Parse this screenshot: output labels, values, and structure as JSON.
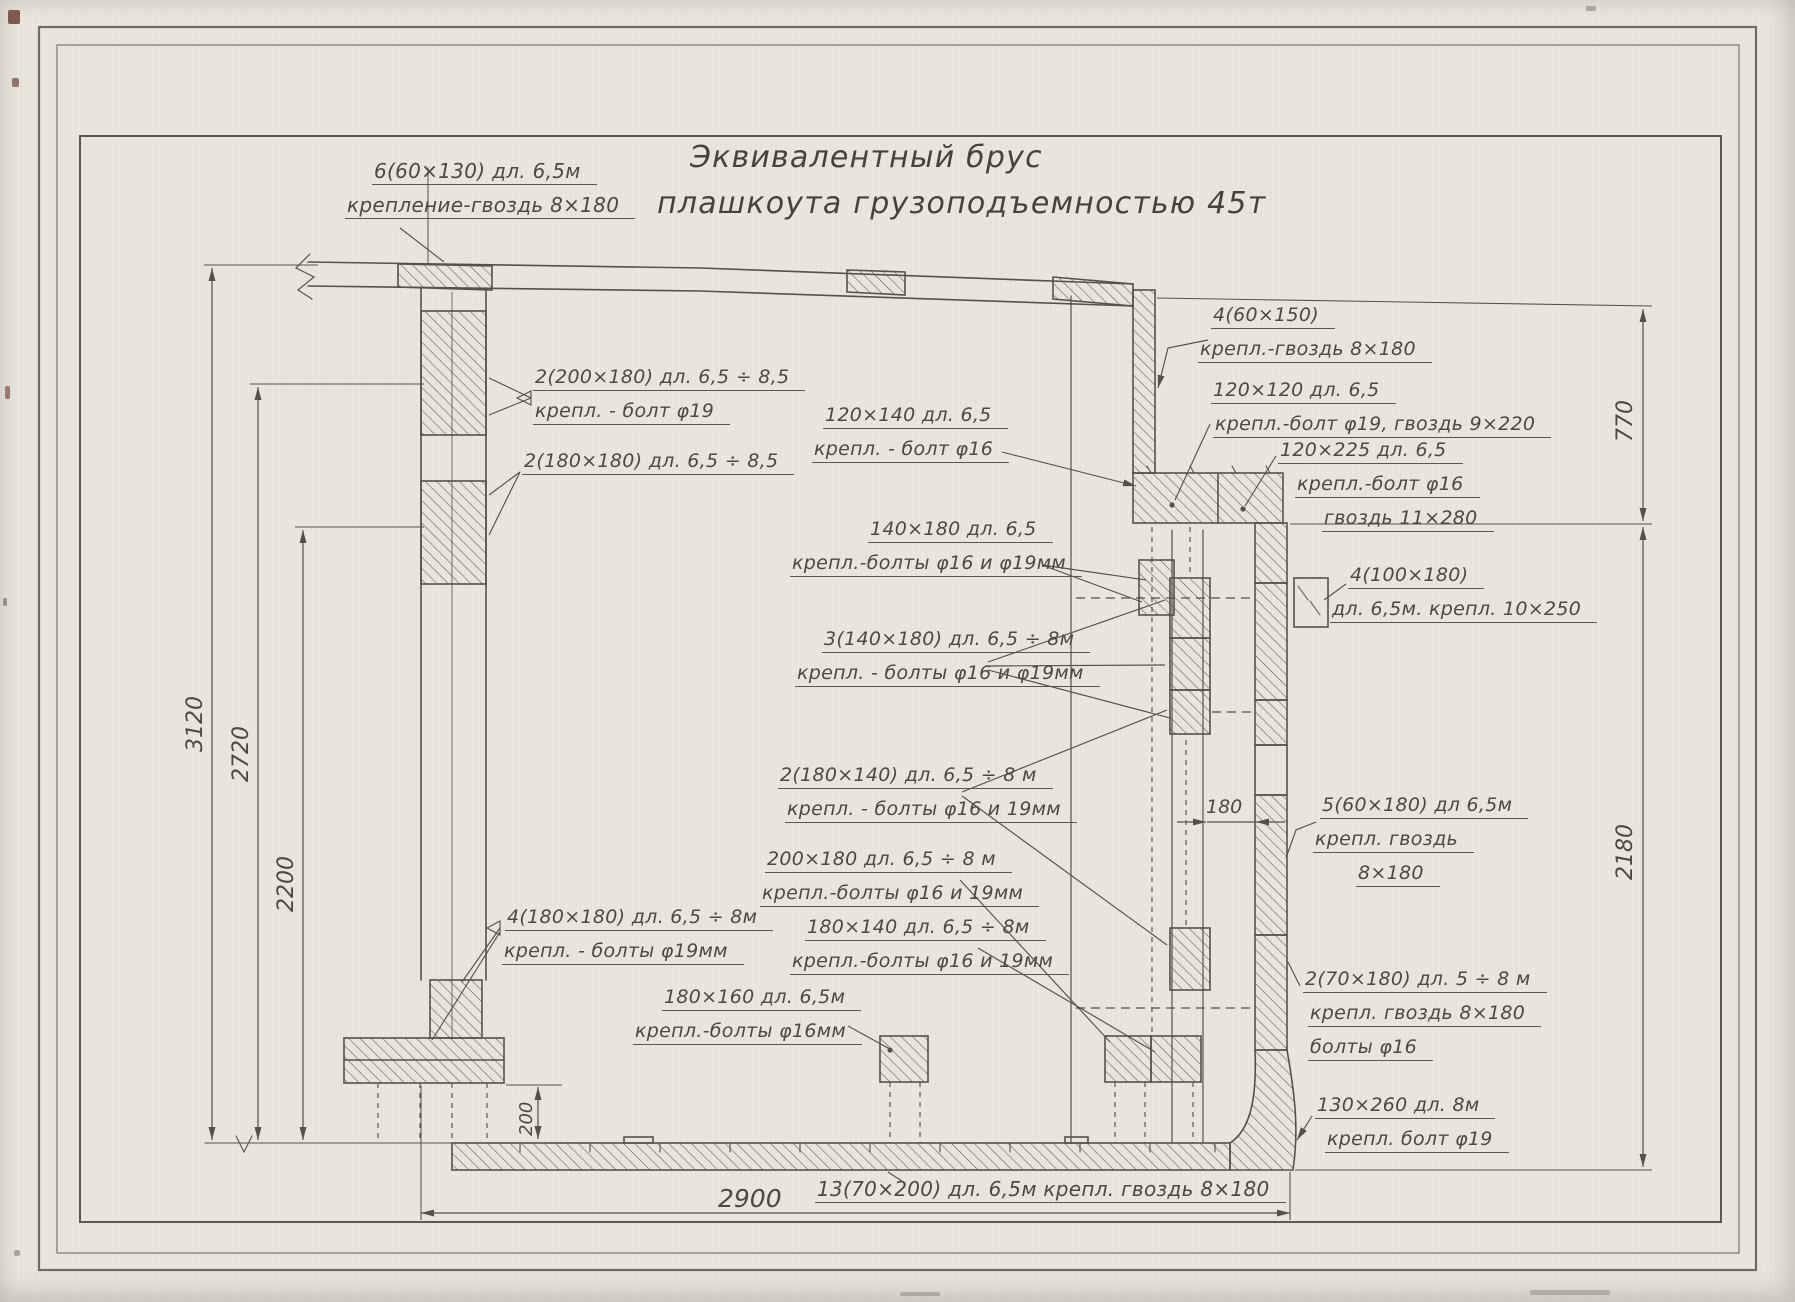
{
  "title": {
    "line1": "Эквивалентный брус",
    "line2": "плашкоута грузоподъемностью 45т"
  },
  "labels": {
    "deck_chock": {
      "line1": "6(60×130) дл. 6,5м",
      "line2": "крепление-гвоздь 8×180"
    },
    "frame_200x180": {
      "line1": "2(200×180) дл. 6,5 ÷ 8,5",
      "line2": "крепл. - болт φ19"
    },
    "frame_180x180": {
      "line1": "2(180×180) дл. 6,5 ÷ 8,5"
    },
    "beam_120x140": {
      "line1": "120×140 дл. 6,5",
      "line2": "крепл. - болт φ16"
    },
    "beam_140x180": {
      "line1": "140×180 дл. 6,5",
      "line2": "крепл.-болты φ16 и φ19мм"
    },
    "beam_3_140x180": {
      "line1": "3(140×180) дл. 6,5 ÷ 8м",
      "line2": "крепл. - болты φ16 и φ19мм"
    },
    "chock_2_180x140": {
      "line1": "2(180×140) дл. 6,5 ÷ 8 м",
      "line2": "крепл. - болты φ16 и 19мм"
    },
    "chock_200x180": {
      "line1": "200×180 дл. 6,5 ÷ 8 м",
      "line2": "крепл.-болты φ16 и 19мм"
    },
    "chock_180x140": {
      "line1": "180×140 дл. 6,5 ÷ 8м",
      "line2": "крепл.-болты φ16 и 19мм"
    },
    "frame_4_180x180": {
      "line1": "4(180×180) дл. 6,5 ÷ 8м",
      "line2": "крепл. - болты φ19мм"
    },
    "chock_180x160": {
      "line1": "180×160 дл. 6,5м",
      "line2": "крепл.-болты φ16мм"
    },
    "deck_4_60x150": {
      "line1": "4(60×150)",
      "line2": "крепл.-гвоздь 8×180"
    },
    "stringer_120x120": {
      "line1": "120×120 дл. 6,5",
      "line2": "крепл.-болт φ19, гвоздь 9×220"
    },
    "stringer_120x225": {
      "line1": "120×225 дл. 6,5",
      "line2": "крепл.-болт φ16",
      "line3": "гвоздь 11×280"
    },
    "nailer_4_100x180": {
      "line1": "4(100×180)",
      "line2": "дл. 6,5м. крепл. 10×250"
    },
    "shell_5_60x180": {
      "line1": "5(60×180) дл 6,5м",
      "line2": "крепл. гвоздь",
      "line3": "8×180"
    },
    "shell_2_70x180": {
      "line1": "2(70×180) дл. 5 ÷ 8 м",
      "line2": "крепл. гвоздь 8×180",
      "line3": "болты φ16"
    },
    "keel_130x260": {
      "line1": "130×260 дл. 8м",
      "line2": "крепл. болт φ19"
    }
  },
  "bottom_note": "13(70×200) дл. 6,5м крепл. гвоздь 8×180",
  "dimensions": {
    "d3120": "3120",
    "d2720": "2720",
    "d2200": "2200",
    "d200": "200",
    "d770": "770",
    "d2180": "2180",
    "d180": "180",
    "d2900": "2900"
  },
  "colors": {
    "paper": "#e9e6df",
    "line": "#55524a",
    "text": "#4c4944"
  }
}
